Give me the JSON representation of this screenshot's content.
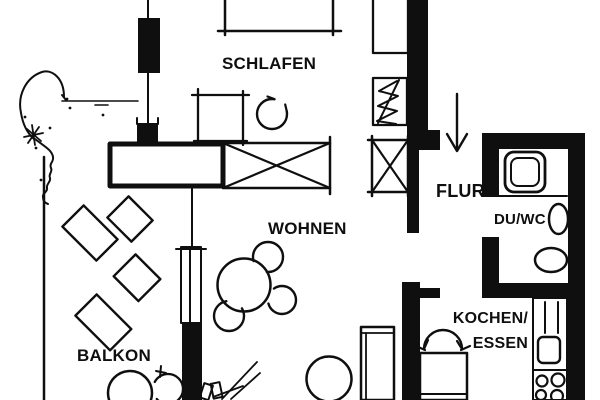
{
  "plan": {
    "title": "apartment-floor-plan",
    "labels": {
      "schlafen": "SCHLAFEN",
      "wohnen": "WOHNEN",
      "balkon": "BALKON",
      "flur": "FLUR",
      "du_wc": "DU/WC",
      "kochen": "KOCHEN/",
      "essen": "ESSEN"
    },
    "colors": {
      "ink": "#0f0f0f",
      "paper": "#ffffff"
    }
  }
}
